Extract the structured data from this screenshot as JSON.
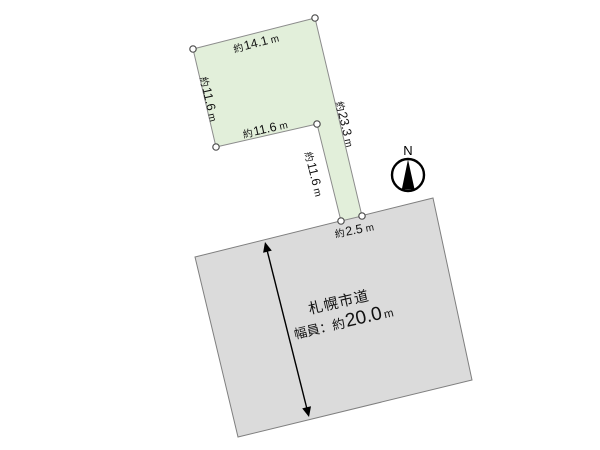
{
  "colors": {
    "background": "#ffffff",
    "parcel_fill": "#e2efda",
    "parcel_stroke": "#8c8c8c",
    "road_fill": "#dbdbdb",
    "road_stroke": "#7f7f7f",
    "vertex_fill": "#ffffff",
    "vertex_stroke": "#4f4f4f",
    "text": "#111111",
    "arrow": "#000000",
    "compass": "#000000"
  },
  "compass": {
    "label": "N"
  },
  "parcel": {
    "edge_labels": [
      {
        "side": "top",
        "prefix": "約",
        "value": "14.1",
        "unit": "m"
      },
      {
        "side": "left",
        "prefix": "約",
        "value": "11.6",
        "unit": "m"
      },
      {
        "side": "inner-bottom",
        "prefix": "約",
        "value": "11.6",
        "unit": "m"
      },
      {
        "side": "right",
        "prefix": "約",
        "value": "23.3",
        "unit": "m"
      },
      {
        "side": "strip-left",
        "prefix": "約",
        "value": "11.6",
        "unit": "m"
      },
      {
        "side": "road-frontage",
        "prefix": "約",
        "value": "2.5",
        "unit": "m"
      }
    ]
  },
  "road": {
    "name": "札幌市道",
    "width_prefix": "幅員：約",
    "width_value": "20.0",
    "width_unit": "m"
  }
}
